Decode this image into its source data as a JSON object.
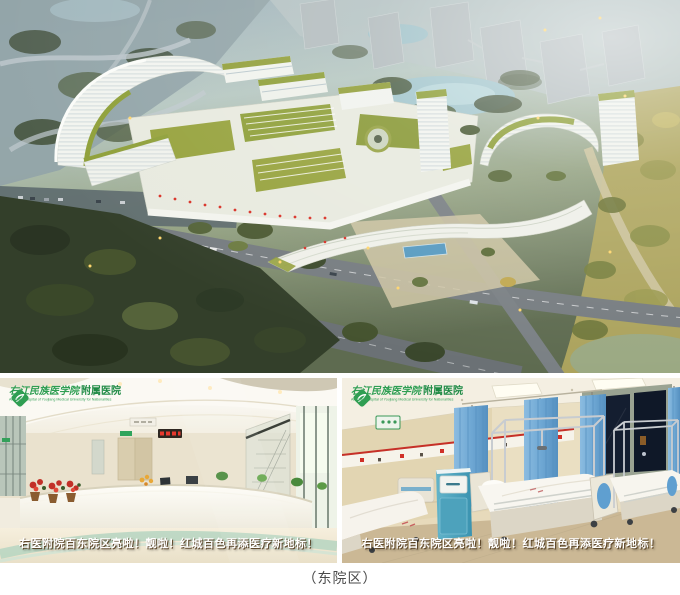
{
  "caption": "（东院区）",
  "banner": {
    "text": "右医附院百东院区亮啦！靓啦！红城百色再添医疗新地标！"
  },
  "logo": {
    "cn_title": "右江民族医学院",
    "cn_suffix": "附属医院",
    "en_subtitle": "Affiliated Hospital of Youjiang Medical University for Nationalities"
  },
  "colors": {
    "logo_green": "#2f9e52",
    "banner_text": "#ffffff",
    "caption_text": "#4a4a4a",
    "roof_green": "#93a03c",
    "curtain_blue": "#6fa8d4"
  }
}
